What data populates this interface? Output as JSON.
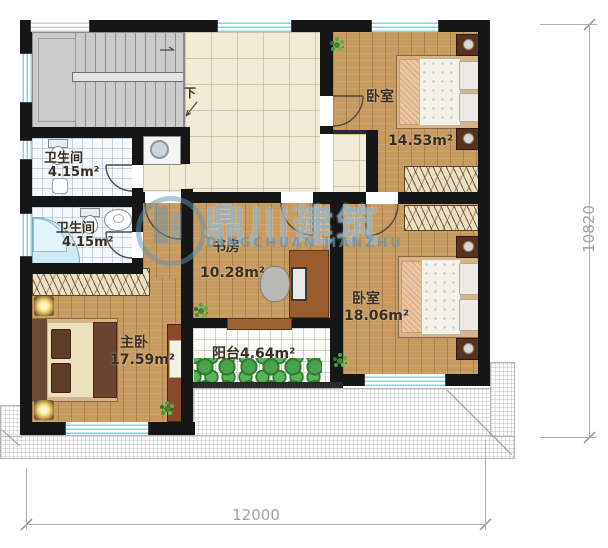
{
  "plan_title": "二层平面图",
  "rooms": {
    "bathroom_upper": {
      "name": "卫生间",
      "area": "4.15m²"
    },
    "bathroom_lower": {
      "name": "卫生间",
      "area": "4.15m²"
    },
    "bedroom_upper": {
      "name": "卧室",
      "area": "14.53m²"
    },
    "bedroom_lower": {
      "name": "卧室",
      "area": "18.06m²"
    },
    "study": {
      "name": "书房",
      "area": "10.28m²"
    },
    "master_bedroom": {
      "name": "主卧",
      "area": "17.59m²"
    },
    "balcony": {
      "label": "阳台4.64m²"
    }
  },
  "annotations": {
    "stairs_down": "下"
  },
  "dimensions": {
    "bottom_width": "12000",
    "right_height": "10820"
  },
  "watermark": {
    "title": "鼎川建筑",
    "subtitle": "DINGCHUAN JIANZHU"
  },
  "colors": {
    "wall": "#161616",
    "wood_floor": "#c79a5f",
    "hall_tile": "#f2ecd6",
    "bath_tile": "#f5f7f9",
    "window_glass": "#8ecfe0",
    "watermark_teal": "#6494b2",
    "plant_green": "#3a9d3a",
    "dimension_gray": "#a2a2a2"
  }
}
